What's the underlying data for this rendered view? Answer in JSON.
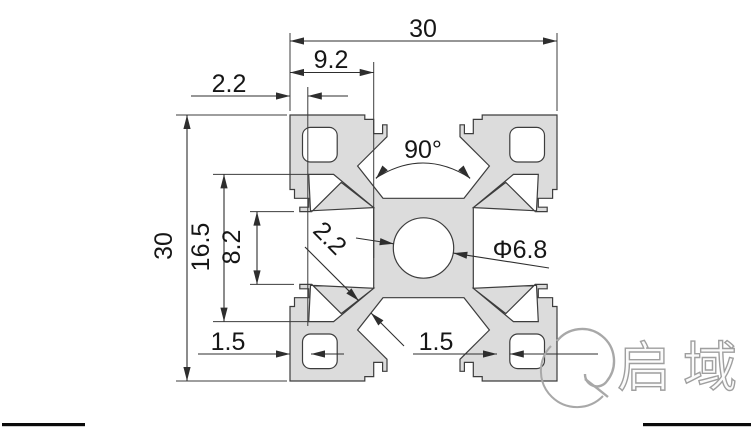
{
  "drawing": {
    "type": "aluminum-extrusion-profile-cross-section",
    "dimensions": {
      "overall_width": "30",
      "overall_height": "30",
      "flange_width": "9.2",
      "top_wall_thickness": "2.2",
      "cavity_span": "16.5",
      "slot_opening": "8.2",
      "slot_angle": "90°",
      "center_hole_diameter": "Φ6.8",
      "web_thickness": "2.2",
      "bottom_left_wall": "1.5",
      "bottom_right_wall": "1.5"
    },
    "logo": {
      "text": "启域"
    },
    "colors": {
      "profile_fill": "#dcdcdc",
      "line": "#3d3d3d",
      "dim_text": "#161616",
      "logo_gray": "#a8a8a8"
    }
  }
}
